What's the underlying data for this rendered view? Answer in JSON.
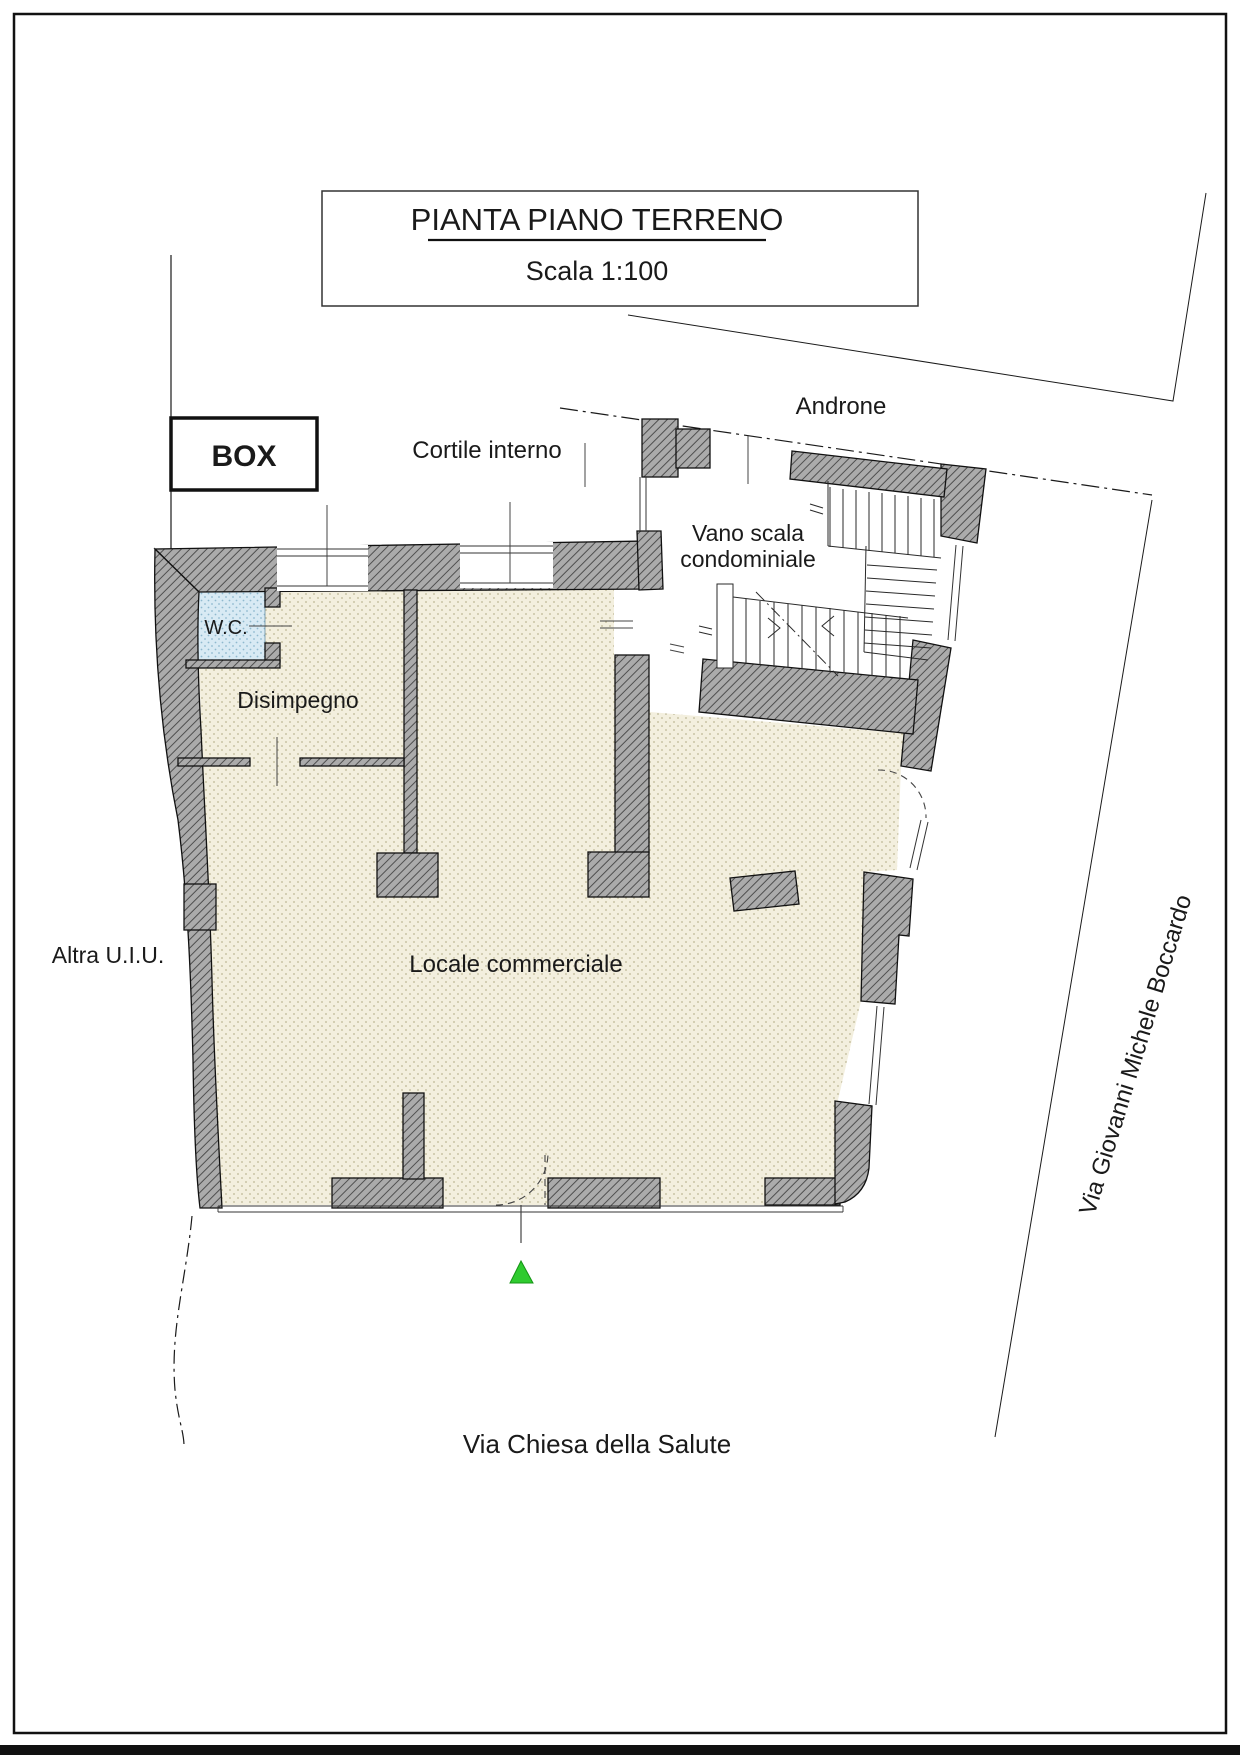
{
  "drawing": {
    "type": "architectural-floor-plan",
    "title_block": {
      "title": "PIANTA PIANO TERRENO",
      "scale": "Scala 1:100"
    },
    "rooms": {
      "wc": "W.C.",
      "disimpegno": "Disimpegno",
      "locale_commerciale": "Locale commerciale",
      "vano_scala_line1": "Vano scala",
      "vano_scala_line2": "condominiale"
    },
    "site_labels": {
      "box": "BOX",
      "cortile_interno": "Cortile interno",
      "androne": "Androne",
      "altra_uiu": "Altra U.I.U.",
      "via_boccardo": "Via Giovanni Michele Boccardo",
      "via_chiesa": "Via Chiesa della Salute"
    },
    "marker": {
      "shape": "triangle-up",
      "color": "#2fcb2f"
    },
    "colors": {
      "wall_fill": "#ababab",
      "wall_hatch": "#4f4f4f",
      "floor_fill": "#f3efde",
      "floor_dots": "#bdb695",
      "wc_fill": "#d8eaf4",
      "wc_dots": "#8fb9ce",
      "line": "#1a1a1a"
    }
  }
}
